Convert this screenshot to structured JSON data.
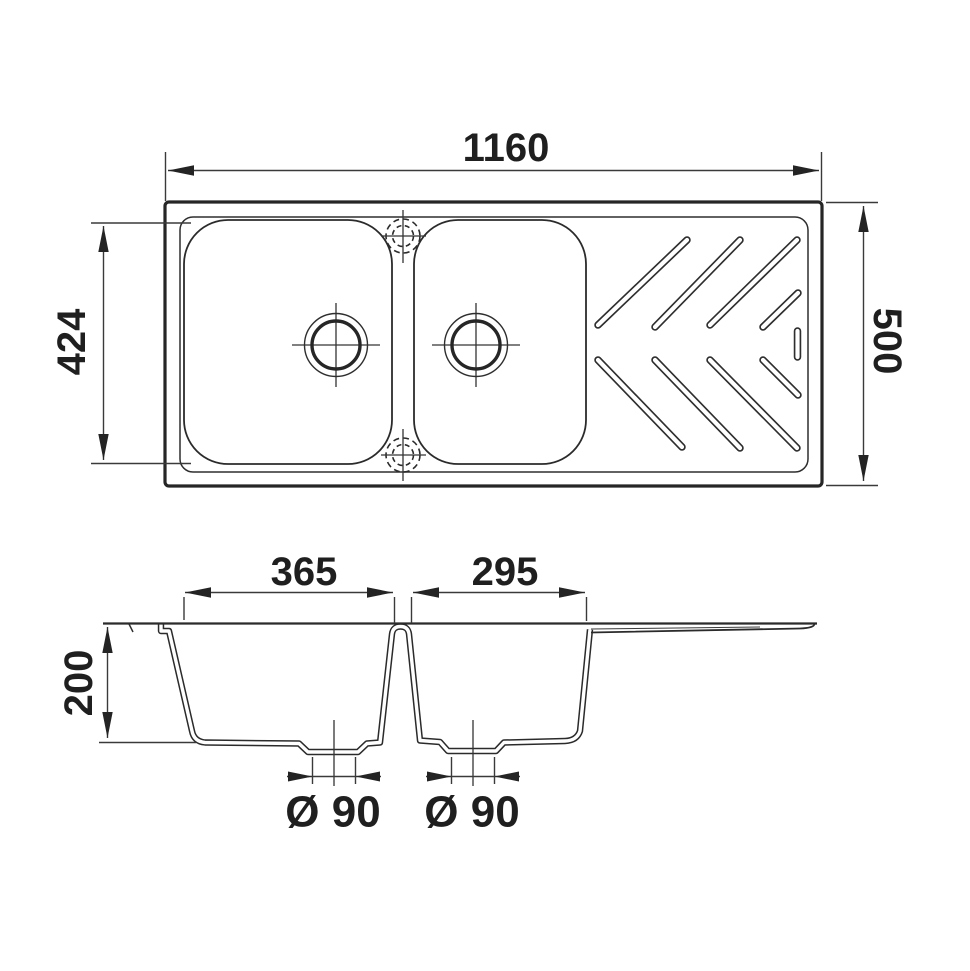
{
  "colors": {
    "line": "#262626",
    "dimension_line": "#3a3a3a",
    "text": "#1f1f1f",
    "background": "#ffffff"
  },
  "top_view": {
    "overall_width_label": "1160",
    "overall_depth_label": "500",
    "bowl_length_label": "424"
  },
  "section_view": {
    "bowl1_width_label": "365",
    "bowl2_width_label": "295",
    "bowl_depth_label": "200",
    "drain1_label": "Ø 90",
    "drain2_label": "Ø 90"
  }
}
